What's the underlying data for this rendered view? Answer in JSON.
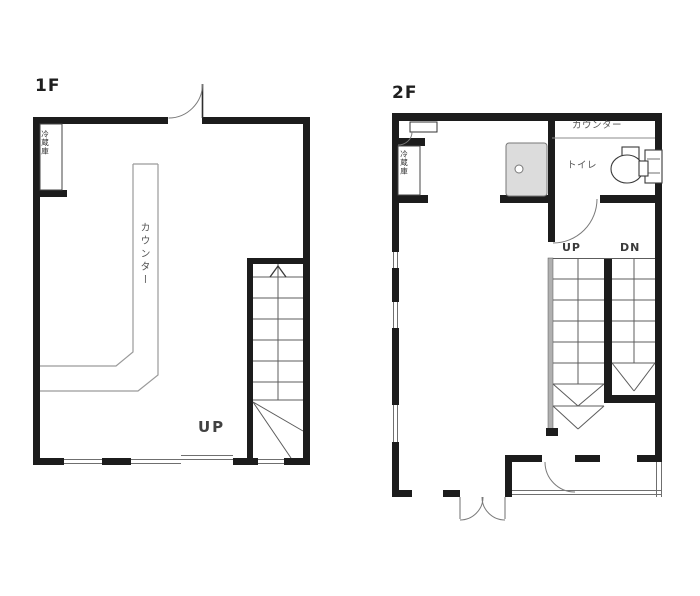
{
  "floors": {
    "f1": {
      "label": "1F",
      "counter_label": "カウンター",
      "storage_label": "冷蔵庫",
      "stairs_up_label": "UP"
    },
    "f2": {
      "label": "2F",
      "counter_label": "カウンター",
      "storage_label": "冷蔵庫",
      "toilet_label": "トイレ",
      "stairs_up_label": "UP",
      "stairs_down_label": "DN"
    }
  },
  "colors": {
    "wall": "#1c1c1c",
    "thin_line": "#6f6f6f",
    "counter_line": "#9a9a9a",
    "equipment_fill": "#dcdcdc",
    "label_text": "#3a3a3a",
    "background": "#ffffff"
  }
}
